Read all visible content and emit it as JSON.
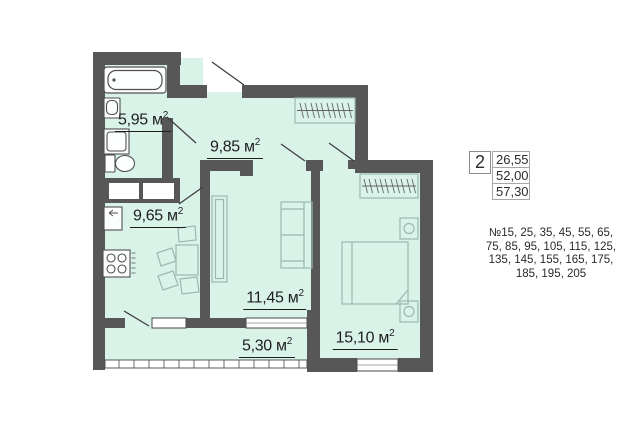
{
  "colors": {
    "wall": "#575757",
    "room_fill": "#d9f3e9",
    "fixture_dark": "#4f4f4f",
    "furniture_light": "#9cb8ae",
    "text": "#1e1e1e"
  },
  "plan": {
    "sup": "2",
    "rooms": [
      {
        "name": "bathroom",
        "area": "5,95 м"
      },
      {
        "name": "hallway",
        "area": "9,85 м"
      },
      {
        "name": "kitchen",
        "area": "9,65 м"
      },
      {
        "name": "living-room",
        "area": "11,45 м"
      },
      {
        "name": "balcony",
        "area": "5,30 м"
      },
      {
        "name": "bedroom",
        "area": "15,10 м"
      }
    ]
  },
  "panel": {
    "rooms_count": "2",
    "areas": [
      "26,55",
      "52,00",
      "57,30"
    ],
    "apartment_numbers_lines": [
      "№15, 25, 35, 45, 55, 65,",
      "75, 85, 95, 105, 115, 125,",
      "135, 145, 155, 165, 175,",
      "185, 195, 205"
    ]
  }
}
